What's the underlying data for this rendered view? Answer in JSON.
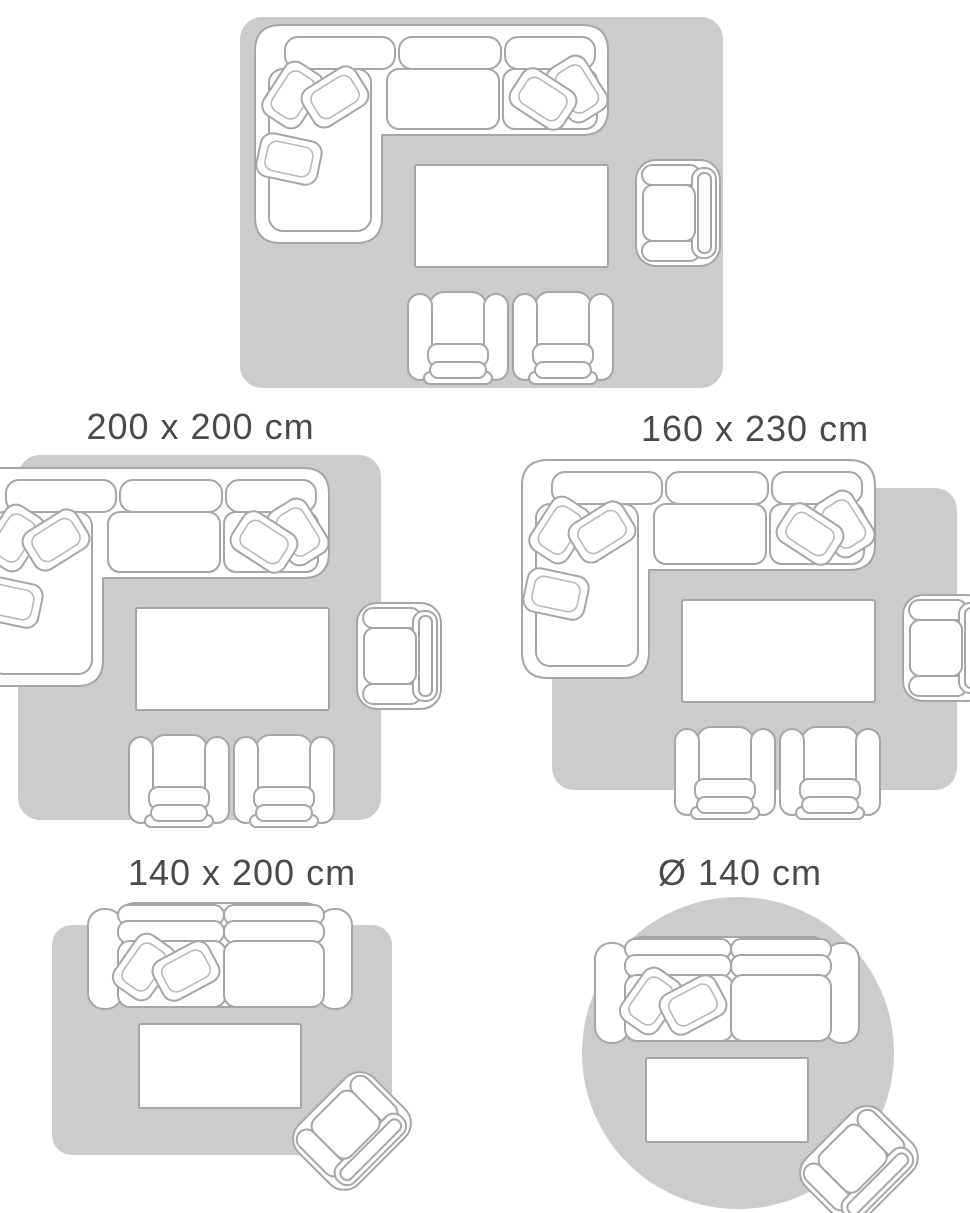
{
  "image_type": "rug-size-guide",
  "colors": {
    "rug_fill": "#cccccc",
    "furniture_outline": "#a6a6a6",
    "furniture_outline_light": "#b9b9b9",
    "furniture_fill": "#ffffff",
    "label_text": "#4a4a4a",
    "background": "#ffffff"
  },
  "size_guide": {
    "items": [
      {
        "label": "200 x 300 cm",
        "rug_shape": "rectangle",
        "note": "title partially cut off at top of image; full furniture set fits on rug"
      },
      {
        "label": "200 x 200 cm",
        "rug_shape": "square",
        "note": "sectional sofa overhangs left edge, armchair overhangs right edge"
      },
      {
        "label": "160 x 230 cm",
        "rug_shape": "rectangle",
        "note": "sectional sofa overhangs top-left, armchair overhangs right, footstools overhang bottom"
      },
      {
        "label": "140 x 200 cm",
        "rug_shape": "rectangle",
        "note": "two-seat sofa overhangs top edge, tilted armchair overhangs bottom-right corner"
      },
      {
        "label": "Ø 140 cm",
        "rug_shape": "circle",
        "note": "round rug; two-seat sofa at top, tilted armchair at bottom-right"
      }
    ]
  }
}
